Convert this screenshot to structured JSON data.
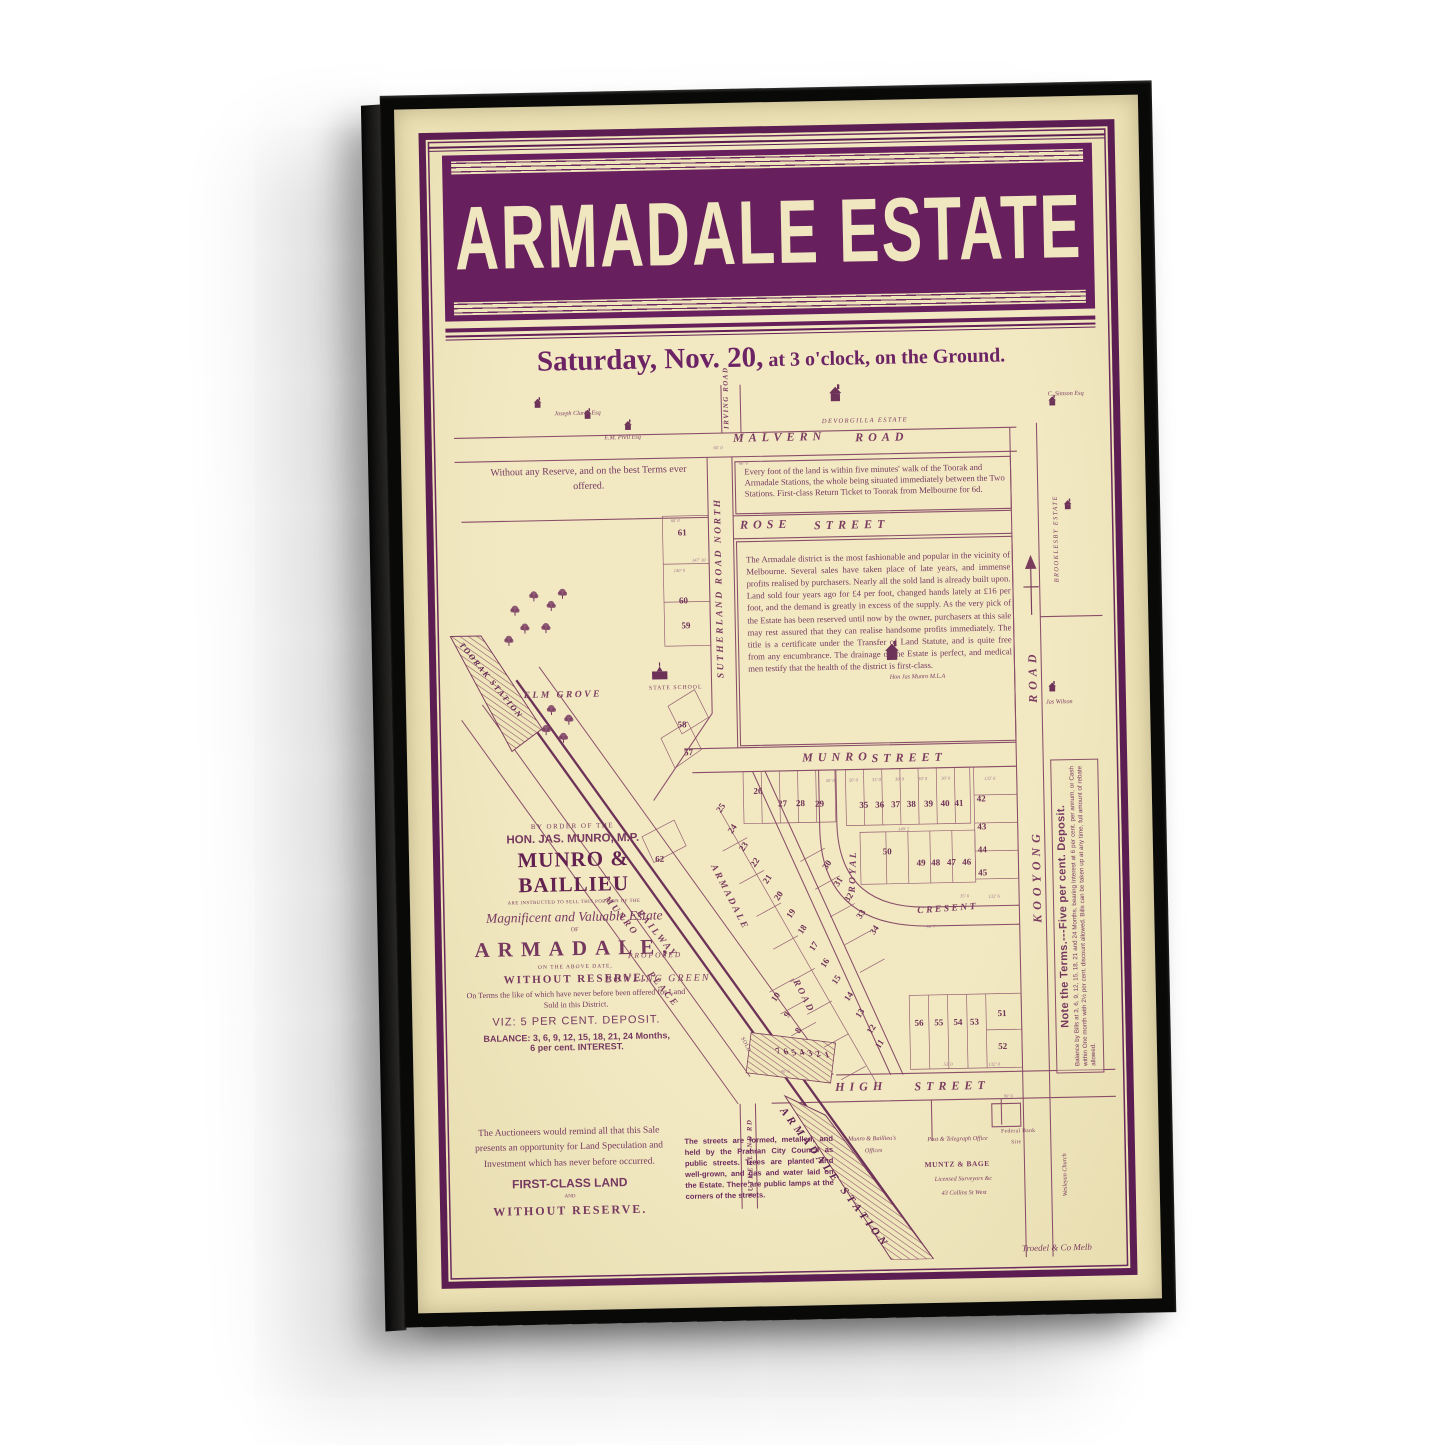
{
  "poster": {
    "title": "ARMADALE ESTATE",
    "auction_date": "Saturday, Nov. 20,",
    "auction_time": " at 3 o'clock, on the Ground."
  },
  "notices": {
    "no_reserve": "Without any Reserve, and on the best Terms ever offered.",
    "walk": "Every foot of the land is within five minutes' walk of the Toorak and Armadale Stations, the whole being situated immediately between the Two Stations.  First-class Return Ticket to Toorak from Melbourne for 6d.",
    "district": "The Armadale district is the most fashionable and popular in the vicinity of Melbourne.  Several sales have taken place of late years, and immense profits realised by purchasers.  Nearly all the sold land is already built upon.  Land sold four years ago for £4 per foot, changed hands lately at £16 per foot, and the demand is greatly in excess of the supply.  As the very pick of the Estate has been reserved until now by the owner, purchasers at this sale may rest assured that they can realise handsome profits immediately.  The title is a certificate under the Transfer of Land Statute, and is quite free from any encumbrance.  The drainage of the Estate is perfect, and medical men testify that the health of the district is first-class.",
    "auctioneers": "The Auctioneers would remind all that this Sale presents an opportunity for Land Speculation and Investment which has never before occurred.",
    "first_class": "FIRST-CLASS LAND",
    "and_word": "AND",
    "without_reserve": "WITHOUT RESERVE.",
    "streets_formed": "The streets are formed, metalled, and held by the Prahran City Council as public streets. Trees are planted and well-grown, and gas and water laid on the Estate. There are public lamps at the corners of the streets."
  },
  "sale_block": {
    "by_order": "BY ORDER OF THE",
    "munro_mp": "HON. JAS. MUNRO, M.P.",
    "firm": "MUNRO & BAILLIEU",
    "instructed": "ARE INSTRUCTED TO SELL THIS PORTION OF THE",
    "magnificent": "Magnificent and Valuable Estate",
    "of_word": "OF",
    "estate_name": "ARMADALE,",
    "above_date": "ON THE ABOVE DATE,",
    "without_reserve": "WITHOUT RESERVE.",
    "terms_note": "On Terms the like of which have never before been offered for Land Sold in this District.",
    "viz": "VIZ: 5 PER CENT. DEPOSIT.",
    "balance1": "BALANCE: 3, 6, 9, 12, 15, 18, 21, 24 Months,",
    "balance2": "6 per cent. INTEREST."
  },
  "terms_sidebar": {
    "headline": "Note the Terms.---Five per cent. Deposit.",
    "body": "Balance by Bills at 3, 6, 9, 12, 15, 18, 21 and 24 Months, bearing Interest at 6 per cent. per annum, or Cash within One month with 2½ per cent. discount allowed.  Bills can be taken up at any time, full amount of rebate allowed."
  },
  "map": {
    "labels": [
      {
        "t": "MALVERN",
        "x": 44,
        "y": 5.6,
        "c": "street"
      },
      {
        "t": "ROAD",
        "x": 62.5,
        "y": 5.8,
        "c": "street"
      },
      {
        "t": "ROSE",
        "x": 44.8,
        "y": 15.5,
        "c": "street"
      },
      {
        "t": "STREET",
        "x": 56,
        "y": 15.7,
        "c": "street"
      },
      {
        "t": "MUNRO",
        "x": 53.5,
        "y": 42.1,
        "c": "street"
      },
      {
        "t": "STREET",
        "x": 64,
        "y": 42.3,
        "c": "street"
      },
      {
        "t": "HIGH",
        "x": 57.5,
        "y": 79.5,
        "c": "street"
      },
      {
        "t": "STREET",
        "x": 69.5,
        "y": 79.7,
        "c": "street"
      },
      {
        "t": "ELM GROVE",
        "x": 11.5,
        "y": 34.7,
        "c": "street2"
      },
      {
        "t": "ROYAL",
        "x": 60.2,
        "y": 58.2,
        "r": -87,
        "c": "street2"
      },
      {
        "t": "CRESENT",
        "x": 70.5,
        "y": 60,
        "r": -3,
        "c": "street2"
      },
      {
        "t": "KOOYONG",
        "x": 87.8,
        "y": 62,
        "r": -90,
        "c": "street"
      },
      {
        "t": "ROAD",
        "x": 87.8,
        "y": 37,
        "r": -90,
        "c": "street"
      },
      {
        "t": "SUTHERLAND ROAD NORTH",
        "x": 40.9,
        "y": 33.5,
        "r": -90,
        "c": "street2"
      },
      {
        "t": "SUTHERLAND RD",
        "x": 44,
        "y": 92.5,
        "r": -90,
        "c": "tinyst"
      },
      {
        "t": "IRVING ROAD",
        "x": 42.5,
        "y": 5.2,
        "r": -90,
        "c": "tinyst"
      },
      {
        "t": "ARMADALE",
        "x": 40.2,
        "y": 54.6,
        "r": 64,
        "c": "street2"
      },
      {
        "t": "ROAD",
        "x": 52.3,
        "y": 67.8,
        "r": 64,
        "c": "street2"
      },
      {
        "t": "MUNRO",
        "x": 23.8,
        "y": 58,
        "r": 52,
        "c": "street2"
      },
      {
        "t": "RAILWAY",
        "x": 28.6,
        "y": 59.6,
        "r": 52,
        "c": "street2"
      },
      {
        "t": "PLACE",
        "x": 30.2,
        "y": 66.6,
        "r": 52,
        "c": "street2"
      },
      {
        "t": "TOORAK STATION",
        "x": 2.6,
        "y": 28.8,
        "r": 52,
        "c": "station2"
      },
      {
        "t": "ARMADALE STATION",
        "x": 50,
        "y": 82.3,
        "r": 54,
        "c": "station"
      },
      {
        "t": "PROPOSED",
        "x": 26.5,
        "y": 64.4,
        "c": "prop"
      },
      {
        "t": "BOWLING GREEN",
        "x": 23,
        "y": 67.1,
        "c": "proplg"
      },
      {
        "t": "SOLD",
        "x": 43.8,
        "y": 74.3,
        "r": 64,
        "c": "tiny"
      },
      {
        "t": "DEVORGILLA ESTATE",
        "x": 57.5,
        "y": 4.3,
        "c": "est"
      },
      {
        "t": "BROOKLESBY ESTATE",
        "x": 92.2,
        "y": 23.4,
        "r": -90,
        "c": "est"
      },
      {
        "t": "Joseph Clarke Esq",
        "x": 17,
        "y": 2.8,
        "c": "tinyi"
      },
      {
        "t": "E.M. Prell Esq",
        "x": 24.5,
        "y": 5.7,
        "c": "tinyi"
      },
      {
        "t": "C. Simson Esq",
        "x": 91.8,
        "y": 1.7,
        "c": "tinyi"
      },
      {
        "t": "Hon Jas Munro M.L.A",
        "x": 67,
        "y": 33.5,
        "c": "tinyi"
      },
      {
        "t": "Jas Wilson",
        "x": 90.6,
        "y": 36.7,
        "c": "tinyi"
      },
      {
        "t": "Wesleyan Church",
        "x": 91.7,
        "y": 93.2,
        "r": -90,
        "c": "tinyi"
      },
      {
        "t": "STATE SCHOOL",
        "x": 30.5,
        "y": 34.3,
        "c": "tinycaps"
      },
      {
        "t": "Munro & Baillieu's",
        "x": 59.3,
        "y": 85.9,
        "c": "tinyi"
      },
      {
        "t": "Offices",
        "x": 61.8,
        "y": 87.3,
        "c": "tinyi"
      },
      {
        "t": "Post & Telegraph Office",
        "x": 71.3,
        "y": 86.1,
        "c": "tinyi"
      },
      {
        "t": "Federal Bank",
        "x": 82.5,
        "y": 85.5,
        "c": "tiny"
      },
      {
        "t": "Site",
        "x": 84,
        "y": 86.7,
        "c": "tiny"
      },
      {
        "t": "MUNTZ & BAGE",
        "x": 70.8,
        "y": 88.9,
        "c": "smallbold"
      },
      {
        "t": "Licensed Surveyors &c",
        "x": 72.3,
        "y": 90.7,
        "c": "tinyi"
      },
      {
        "t": "43 Collins St West",
        "x": 73.3,
        "y": 92.3,
        "c": "tinyi"
      },
      {
        "t": "Troedel & Co Melb",
        "x": 85.3,
        "y": 98.5,
        "c": "printer"
      }
    ],
    "lots": [
      {
        "n": "61",
        "x": 36,
        "y": 16.9
      },
      {
        "n": "60",
        "x": 36,
        "y": 24.7
      },
      {
        "n": "59",
        "x": 36.3,
        "y": 27.5
      },
      {
        "n": "58",
        "x": 35.4,
        "y": 38.7
      },
      {
        "n": "57",
        "x": 36.3,
        "y": 41.9
      },
      {
        "n": "62",
        "x": 31.6,
        "y": 54
      },
      {
        "n": "26",
        "x": 46.7,
        "y": 46.5
      },
      {
        "n": "27",
        "x": 50.4,
        "y": 48
      },
      {
        "n": "28",
        "x": 53.1,
        "y": 48
      },
      {
        "n": "29",
        "x": 56,
        "y": 48.1
      },
      {
        "n": "35",
        "x": 62.7,
        "y": 48.3
      },
      {
        "n": "36",
        "x": 65.1,
        "y": 48.3
      },
      {
        "n": "37",
        "x": 67.5,
        "y": 48.3
      },
      {
        "n": "38",
        "x": 69.9,
        "y": 48.3
      },
      {
        "n": "39",
        "x": 72.5,
        "y": 48.3
      },
      {
        "n": "40",
        "x": 75,
        "y": 48.3
      },
      {
        "n": "41",
        "x": 77.1,
        "y": 48.3
      },
      {
        "n": "42",
        "x": 80.5,
        "y": 47.8
      },
      {
        "n": "43",
        "x": 80.5,
        "y": 51
      },
      {
        "n": "44",
        "x": 80.5,
        "y": 53.6
      },
      {
        "n": "45",
        "x": 80.5,
        "y": 56.3
      },
      {
        "n": "50",
        "x": 66.1,
        "y": 53.6
      },
      {
        "n": "49",
        "x": 71.2,
        "y": 55
      },
      {
        "n": "48",
        "x": 73.4,
        "y": 55
      },
      {
        "n": "47",
        "x": 75.8,
        "y": 55
      },
      {
        "n": "46",
        "x": 78.1,
        "y": 55
      },
      {
        "n": "25",
        "x": 41,
        "y": 48.3,
        "r": -55
      },
      {
        "n": "24",
        "x": 42.7,
        "y": 50.7,
        "r": -55
      },
      {
        "n": "23",
        "x": 44.4,
        "y": 52.7,
        "r": -55
      },
      {
        "n": "22",
        "x": 46.1,
        "y": 54.6,
        "r": -55
      },
      {
        "n": "21",
        "x": 47.9,
        "y": 56.5,
        "r": -55
      },
      {
        "n": "20",
        "x": 49.6,
        "y": 58.4,
        "r": -55
      },
      {
        "n": "19",
        "x": 51.3,
        "y": 60.4,
        "r": -55
      },
      {
        "n": "18",
        "x": 53,
        "y": 62.3,
        "r": -55
      },
      {
        "n": "17",
        "x": 54.7,
        "y": 64.2,
        "r": -55
      },
      {
        "n": "16",
        "x": 56.4,
        "y": 66.1,
        "r": -55
      },
      {
        "n": "15",
        "x": 58.1,
        "y": 68.1,
        "r": -55
      },
      {
        "n": "14",
        "x": 59.8,
        "y": 70,
        "r": -55
      },
      {
        "n": "13",
        "x": 61.5,
        "y": 71.9,
        "r": -55
      },
      {
        "n": "12",
        "x": 63.2,
        "y": 73.8,
        "r": -55
      },
      {
        "n": "11",
        "x": 64.4,
        "y": 75.5,
        "r": -55
      },
      {
        "n": "30",
        "x": 57,
        "y": 55,
        "r": -55
      },
      {
        "n": "31",
        "x": 58.6,
        "y": 56.9,
        "r": -55
      },
      {
        "n": "32",
        "x": 60.2,
        "y": 58.8,
        "r": -55
      },
      {
        "n": "33",
        "x": 61.9,
        "y": 60.7,
        "r": -55
      },
      {
        "n": "34",
        "x": 63.9,
        "y": 62.5,
        "r": -55
      },
      {
        "n": "56",
        "x": 70.4,
        "y": 73.2
      },
      {
        "n": "55",
        "x": 73.4,
        "y": 73.2
      },
      {
        "n": "54",
        "x": 76.3,
        "y": 73.2
      },
      {
        "n": "53",
        "x": 78.8,
        "y": 73.2
      },
      {
        "n": "51",
        "x": 83,
        "y": 72.3
      },
      {
        "n": "52",
        "x": 83,
        "y": 76
      },
      {
        "n": "10",
        "x": 48.8,
        "y": 69.9,
        "r": -55
      },
      {
        "n": "9",
        "x": 50.4,
        "y": 71.9,
        "r": -55
      },
      {
        "n": "8",
        "x": 52.1,
        "y": 73.8,
        "r": -55
      },
      {
        "n": "7",
        "x": 49,
        "y": 76,
        "r": -20
      },
      {
        "n": "6",
        "x": 50.2,
        "y": 76.1,
        "r": -20
      },
      {
        "n": "5",
        "x": 51.4,
        "y": 76.2,
        "r": -20
      },
      {
        "n": "4",
        "x": 52.6,
        "y": 76.3,
        "r": -20
      },
      {
        "n": "3",
        "x": 53.8,
        "y": 76.4,
        "r": -20
      },
      {
        "n": "2",
        "x": 55,
        "y": 76.5,
        "r": -20
      },
      {
        "n": "1",
        "x": 56.3,
        "y": 76.6,
        "r": -20
      }
    ],
    "dimensions": [
      {
        "t": "66' 0",
        "x": 41,
        "y": 7.2
      },
      {
        "t": "66' 0",
        "x": 44.8,
        "y": 9
      },
      {
        "t": "66' 0",
        "x": 34.3,
        "y": 15.3
      },
      {
        "t": "147' 10",
        "x": 37.4,
        "y": 19.9
      },
      {
        "t": "140' 0",
        "x": 34.6,
        "y": 21
      },
      {
        "t": "50' 0",
        "x": 57,
        "y": 45.2
      },
      {
        "t": "50' 0",
        "x": 60.5,
        "y": 45.2
      },
      {
        "t": "33' 0",
        "x": 64,
        "y": 45.2
      },
      {
        "t": "30' 0",
        "x": 67.5,
        "y": 45.2
      },
      {
        "t": "30' 0",
        "x": 71,
        "y": 45.2
      },
      {
        "t": "30' 0",
        "x": 74.5,
        "y": 45.2
      },
      {
        "t": "132' 6",
        "x": 81,
        "y": 45.3
      },
      {
        "t": "149' 2",
        "x": 67.8,
        "y": 50.9
      },
      {
        "t": "35' 6",
        "x": 77,
        "y": 58.6
      },
      {
        "t": "132' 6",
        "x": 81.3,
        "y": 58.8
      },
      {
        "t": "90' 7",
        "x": 71.8,
        "y": 62
      },
      {
        "t": "90' 6",
        "x": 49.3,
        "y": 78.2
      },
      {
        "t": "53' 0",
        "x": 74,
        "y": 77.7
      },
      {
        "t": "132' 0",
        "x": 80.8,
        "y": 77.8
      },
      {
        "t": "90' 6",
        "x": 83,
        "y": 81.5
      }
    ]
  },
  "colors": {
    "banner_purple": "#671f5d",
    "border_purple": "#5c1e52",
    "map_line": "#8a4e68",
    "canvas_cream": "#ebe1b4",
    "poster_cream": "#f0e6bc",
    "frame_black": "#090908"
  }
}
